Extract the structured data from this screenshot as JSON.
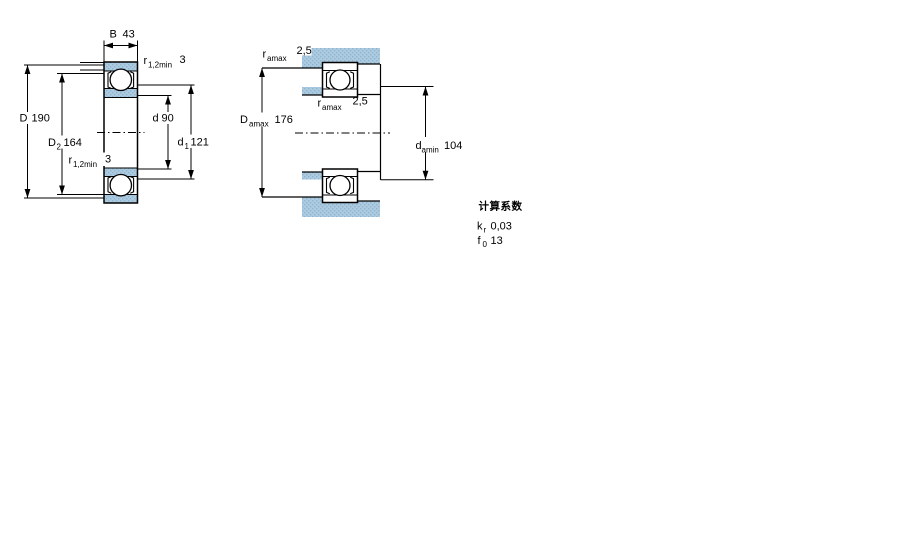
{
  "colors": {
    "steel_base": "#adcbe0",
    "steel_dot": "#8fb4cf",
    "line": "#000000"
  },
  "left_view": {
    "b": {
      "main": "B",
      "value": "43"
    },
    "r_top": {
      "main": "r",
      "sub": "1,2min",
      "value": "3"
    },
    "r_bottom": {
      "main": "r",
      "sub": "1,2min",
      "value": "3"
    },
    "d_outer": {
      "main": "D",
      "value": "190"
    },
    "d2": {
      "main": "D",
      "sub": "2",
      "value": "164"
    },
    "d_bore": {
      "main": "d",
      "value": "90"
    },
    "d1": {
      "main": "d",
      "sub": "1",
      "value": "121"
    }
  },
  "right_view": {
    "ra_top": {
      "main": "r",
      "sub": "amax",
      "value": "2,5"
    },
    "ra_mid": {
      "main": "r",
      "sub": "amax",
      "value": "2,5"
    },
    "da_max": {
      "main": "D",
      "sub": "amax",
      "value": "176"
    },
    "da_min": {
      "main": "d",
      "sub": "amin",
      "value": "104"
    }
  },
  "calculation_factors": {
    "title": "计算系数",
    "kr": {
      "main": "k",
      "sub": "r",
      "value": "0,03"
    },
    "f0": {
      "main": "f",
      "sub": "0",
      "value": "13"
    }
  }
}
